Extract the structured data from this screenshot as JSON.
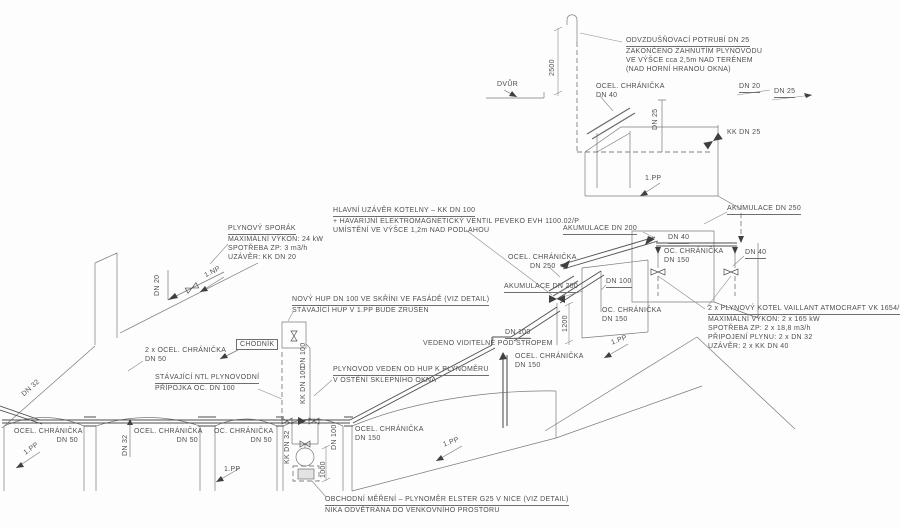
{
  "drawing": {
    "annotations": {
      "vent_note": [
        "ODVZDUŠŇOVACÍ POTRUBÍ DN 25",
        "ZAKONČENO ZAHNUTÍM PLYNOVODU",
        "VE VÝŠCE cca 2,5m NAD TERÉNEM",
        "(NAD HORNÍ HRANOU OKNA)"
      ],
      "main_valve_note": [
        "HLAVNÍ UZÁVĚR KOTELNY – KK DN 100",
        "+ HAVARIJNÍ ELEKTROMAGNETICKÝ VENTIL PEVEKO EVH 1100.02/P",
        "UMÍSTĚNÍ VE VÝŠCE 1,2m NAD PODLAHOU"
      ],
      "boiler_note": [
        "2 x PLYNOVÝ KOTEL VAILLANT ATMOCRAFT VK 1654/9",
        "MAXIMÁLNÍ VÝKON: 2 x 165 kW",
        "SPOTŘEBA ZP: 2 x 18,8 m3/h",
        "PŘIPOJENÍ PLYNU: 2 x DN 32",
        "UZÁVĚR: 2 x KK DN 40"
      ],
      "stove_note": [
        "PLYNOVÝ SPORÁK",
        "MAXIMÁLNÍ VÝKON: 24 kW",
        "SPOTŘEBA ZP: 3 m3/h",
        "UZÁVĚR: KK DN 20"
      ],
      "hup_note": [
        "NOVÝ HUP DN 100 VE SKŘÍNI VE FASÁDĚ (VIZ DETAIL)",
        "STÁVAJÍCÍ HUP V 1.PP BUDE ZRUŠEN"
      ],
      "existing_note": [
        "STÁVAJÍCÍ NTL PLYNOVODNÍ",
        "PŘÍPOJKA OC. DN 100"
      ],
      "meter_route_note": [
        "PLYNOVOD VEDEN OD HUP K PLYNOMĚRU",
        "V OSTĚNÍ SKLEPNÍHO OKNA"
      ],
      "ceiling_dn": "DN 100",
      "ceiling_text": "VEDENO VIDITELNĚ POD STROPEM",
      "meter_note": [
        "OBCHODNÍ MĚŘENÍ – PLYNOMĚR ELSTER G25 V NICE (VIZ DETAIL)",
        "NIKA ODVĚTRÁNA DO VENKOVNÍHO PROSTORU"
      ]
    },
    "pipe_labels": {
      "dn20_top": "DN 20",
      "dn25_top": "DN 25",
      "dn25_riser": "DN 25",
      "kk_dn25": "KK DN 25",
      "akum250": "AKUMULACE DN 250",
      "akum200": "AKUMULACE DN 200",
      "dn40": "DN 40",
      "dn100": "DN 100",
      "kk_dn100": "KK DN 100",
      "kk_dn32": "KK DN 32",
      "dn32": "DN 32",
      "dn20": "DN 20"
    },
    "casings": {
      "dn40": [
        "OCEL. CHRÁNIČKA",
        "DN 40"
      ],
      "dn250": [
        "OCEL. CHRÁNIČKA",
        "DN 250"
      ],
      "dn150_oc": [
        "OC. CHRÁNIČKA",
        "DN 150"
      ],
      "dn150": [
        "OCEL. CHRÁNIČKA",
        "DN 150"
      ],
      "dn50": [
        "OCEL. CHRÁNIČKA",
        "DN 50"
      ],
      "dn50_oc": [
        "OC. CHRÁNIČKA",
        "DN 50"
      ],
      "dn50_double": [
        "2 x OCEL. CHRÁNIČKA",
        "DN 50"
      ]
    },
    "levels": {
      "pp": "1.PP",
      "np": "1.NP",
      "dvur": "DVŮR",
      "chodnik": "CHODNÍK"
    },
    "dimensions": {
      "vent": "2500",
      "valve": "1200",
      "meter": "1000"
    },
    "colors": {
      "line": "#7a7a7a",
      "pipe": "#4d4d4d",
      "text": "#4f4f4f",
      "background": "#fdfdfd"
    }
  }
}
